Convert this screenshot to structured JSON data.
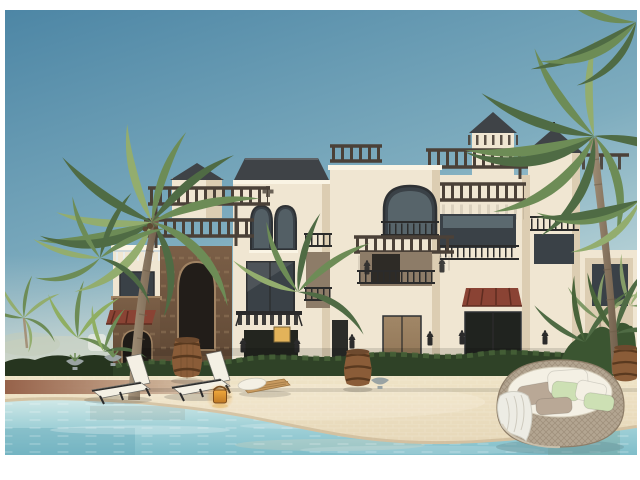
{
  "meta": {
    "description": "Architectural 3D rendering of a Mediterranean-style lagoon villa complex with rooftop pergolas, a stone tower, palm trees, a sandy beach and a turquoise pool with lounge furniture",
    "image_type": "exterior 3D render, no visible text"
  },
  "palette": {
    "frame": "#ffffff",
    "sky_top": "#4d86a5",
    "sky_mid": "#7fadbf",
    "sky_horizon": "#d2e4e2",
    "haze": "#ebe7d9",
    "wall": "#f0e6d2",
    "wall_shade": "#dccdb2",
    "wall_bright": "#faf4e4",
    "glass_dark": "#3a4147",
    "glass_reflect": "#8fa5ad",
    "frame_dark": "#2e3134",
    "pergola_dark": "#4b4138",
    "roof_tile": "#3f4347",
    "stone_dark": "#5e4734",
    "stone_mid": "#7b5f47",
    "stone_light": "#a08363",
    "awning_red": "#8a4334",
    "awning_dark": "#5e2c20",
    "hedge_dark": "#2f4227",
    "hedge_mid": "#49643a",
    "plant_light": "#8fae62",
    "palm_dark": "#4f6b44",
    "palm_mid": "#6d8c56",
    "palm_light": "#93ad6e",
    "trunk": "#a4927a",
    "trunk_dark": "#6e5c49",
    "sand": "#e6d7b8",
    "sand_warm": "#efe3c6",
    "sand_wet": "#c8b392",
    "paver_red": "#96624a",
    "water_deep": "#7fbdc9",
    "water_mid": "#a3d2d8",
    "water_light": "#cfe8e7",
    "cushion_white": "#f4f0e4",
    "cushion_taupe": "#b9a896",
    "cushion_green": "#cde0b4",
    "wicker": "#b3a591",
    "wicker_dark": "#8d7d68",
    "wood_barrel": "#8a5c38",
    "barrel_hoop": "#59391f",
    "lantern_glow": "#f0a93c",
    "lantern_body": "#c07a26",
    "metal_dark": "#2b2b2b",
    "bronze": "#8f7455",
    "lit_window": "#e3b35a"
  },
  "objects": {
    "scene": "lagoon villa resort rendering",
    "sky": "clear blue gradient sky",
    "building": "white Mediterranean villa complex with pergolas and arched windows",
    "left_wing": "left wing with rooftop glass railing",
    "stone_tower": "rustic stone tower with arched opening and rooftop pergola",
    "center_villa": "center villa with hipped tile roof and twin arched windows",
    "mid_villa": "middle villa with arched window, juliet balcony and pergola terrace",
    "right_villa": "right villa with rooftop pergola, tiled cap tower and red tile awning",
    "far_tower": "far right tower with tiled pyramid cap",
    "hedge": "trimmed green hedge row",
    "left_garden": "tropical plants, small fan palms and planter bowls",
    "right_garden": "tropical plants behind the daybed",
    "beach": "sandy paved beach with red paver walkway",
    "pool": "turquoise swimming lagoon",
    "left_palm": "tall coconut palm tree",
    "right_palm": "overhanging palm tree at right edge",
    "loungers": "two white sun loungers at the water edge",
    "wooden_lounger": "low wooden slat lounger with rolled towels",
    "barrels": "decorative wooden barrels",
    "lantern": "glowing amber lantern at the shoreline",
    "daybed": "round wicker daybed with white, taupe and green cushions and a draped throw"
  }
}
